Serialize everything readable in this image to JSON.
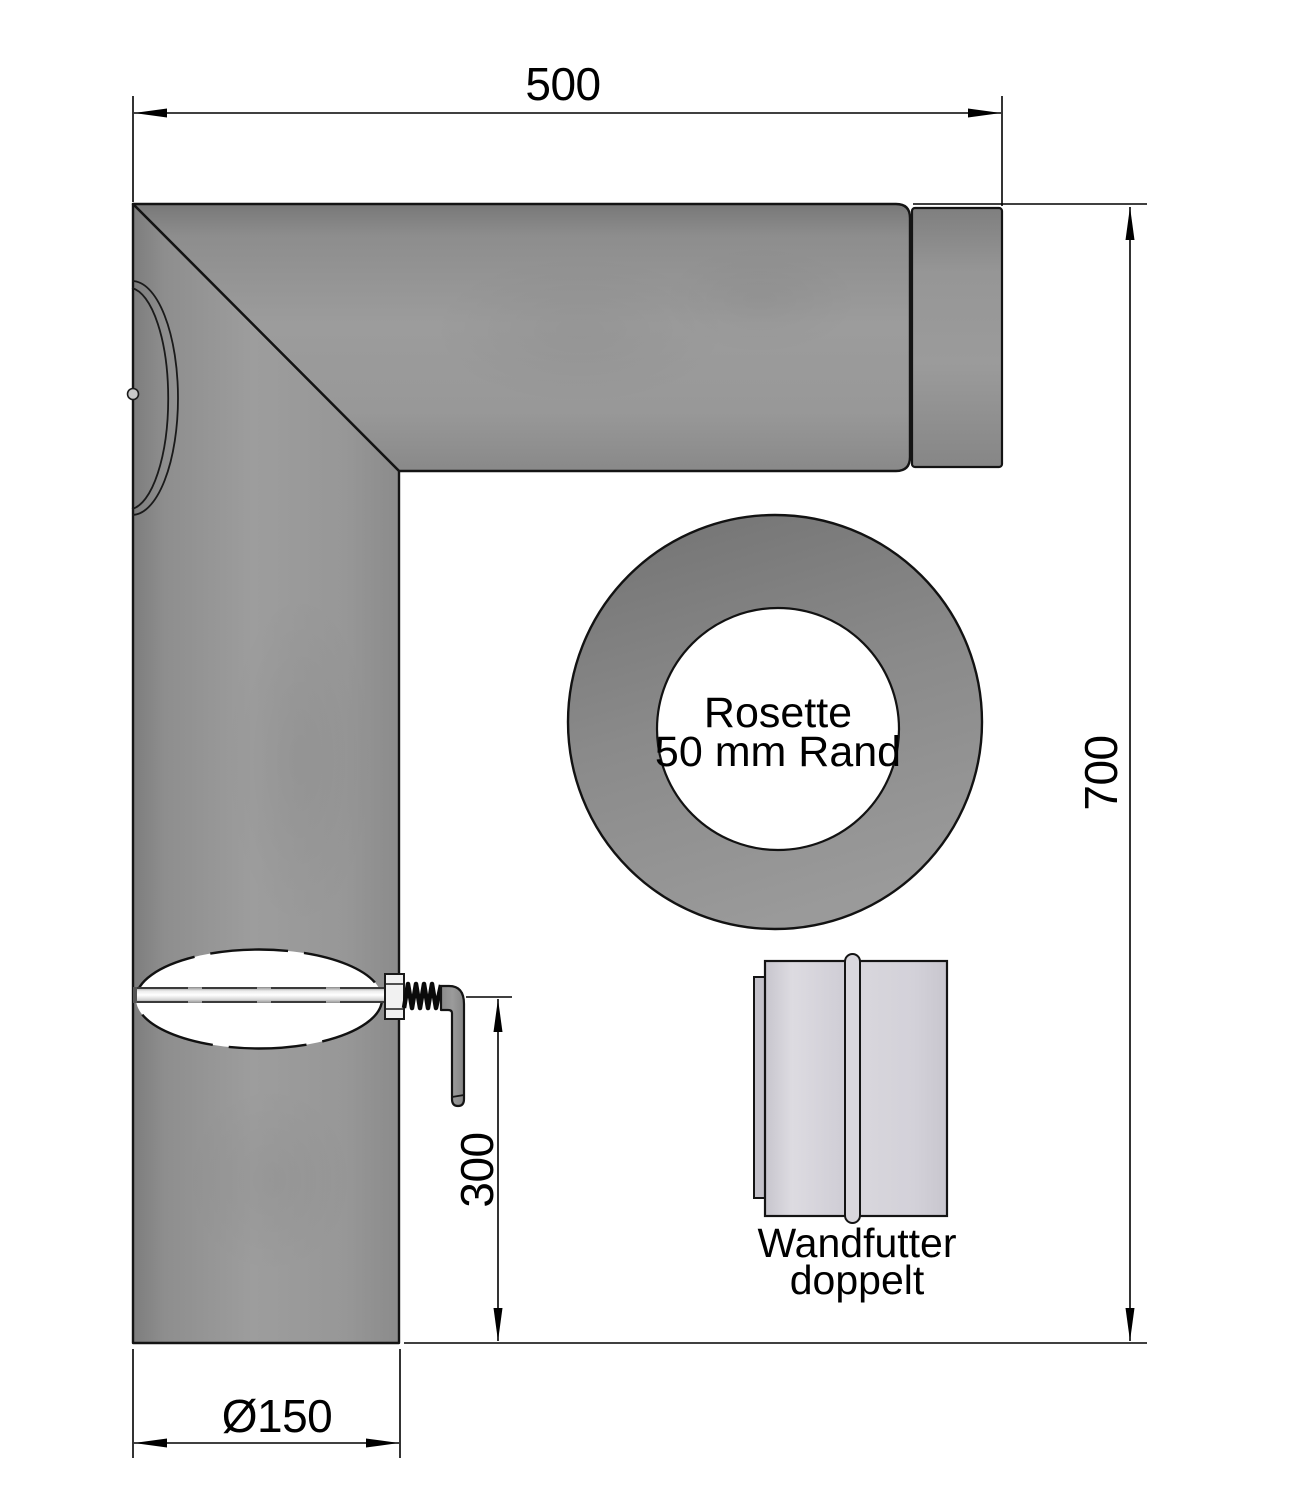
{
  "document": {
    "type": "technical-drawing",
    "background": "#ffffff"
  },
  "dimensions": {
    "horizontal_length": "500",
    "vertical_length": "700",
    "handle_offset": "300",
    "pipe_diameter": "Ø150"
  },
  "parts": {
    "elbow_pipe": {
      "description_names": [
        "elbow-pipe",
        "damper-assembly"
      ]
    },
    "rosette": {
      "label_line1": "Rosette",
      "label_line2": "50 mm Rand"
    },
    "wall_sleeve": {
      "label_line1": "Wandfutter",
      "label_line2": "doppelt"
    }
  },
  "colors": {
    "outline": "#141414",
    "dimension_line": "#000000",
    "text": "#000000",
    "pipe_gray": "#949494",
    "pipe_edge_dark": "#7c7c7c",
    "collar_gray": "#909090",
    "rosette_gray": "#878787",
    "sleeve_gray": "#d4d2d8",
    "damper_disc_white": "#ffffff",
    "rod_light": "#ececec"
  }
}
